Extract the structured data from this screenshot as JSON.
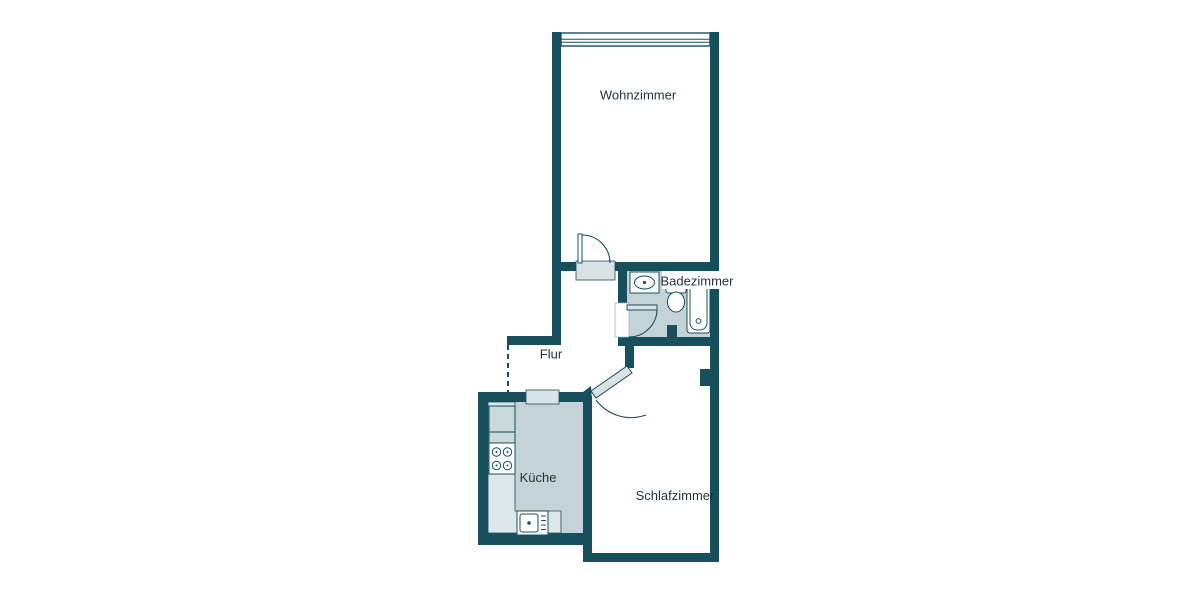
{
  "plan": {
    "type": "floor-plan",
    "language": "de",
    "rooms": {
      "wohnzimmer": {
        "label": "Wohnzimmer"
      },
      "badezimmer": {
        "label": "Badezimmer"
      },
      "flur": {
        "label": "Flur"
      },
      "kueche": {
        "label": "Küche"
      },
      "schlafzimmer": {
        "label": "Schlafzimmer"
      }
    },
    "fixtures": [
      "window",
      "door",
      "bathtub",
      "toilet",
      "washbasin",
      "stove",
      "kitchen-sink"
    ],
    "colors": {
      "wall": "#17505c",
      "room_fill": "#c3d3d7",
      "counter_fill": "#dde7e9",
      "cabinet_fill": "#c9d9dc",
      "threshold_fill": "#d9e3e5",
      "fixture_fill": "#ffffff",
      "label": "#1d3340",
      "background": "#ffffff"
    }
  }
}
